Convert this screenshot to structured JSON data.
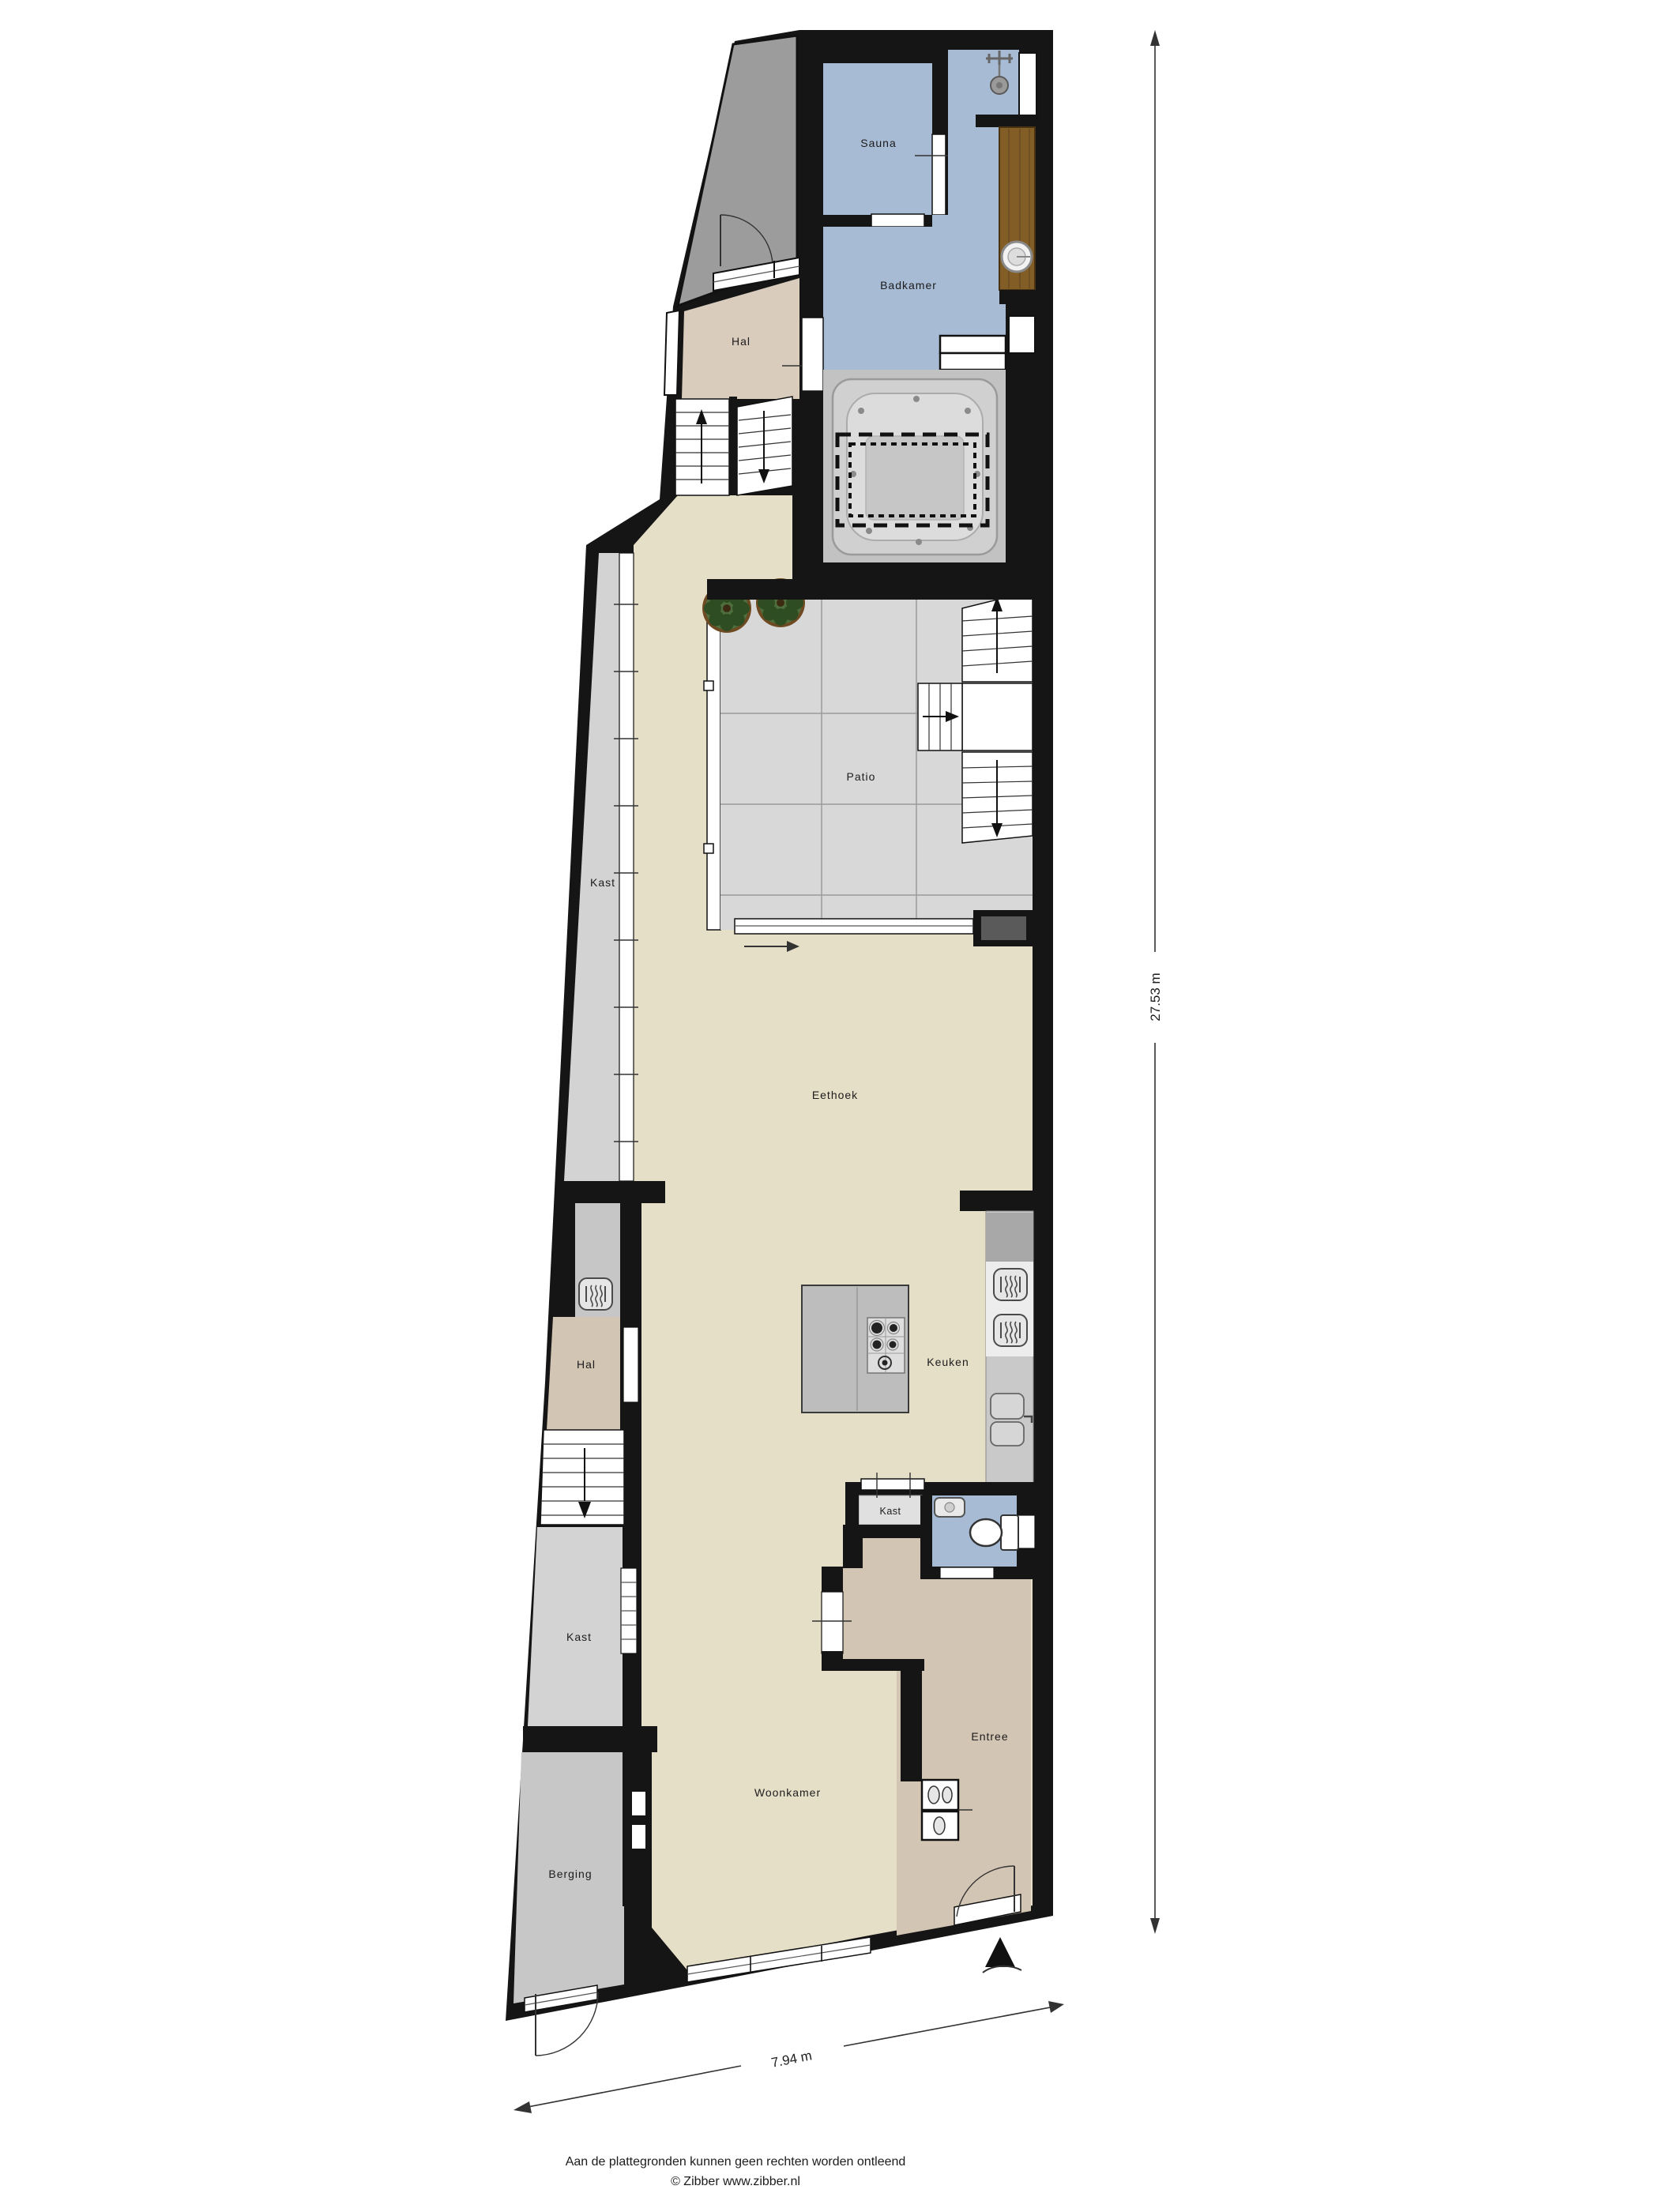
{
  "plan": {
    "title": "Begane grond plattegrond",
    "rooms": [
      {
        "id": "sauna",
        "label": "Sauna"
      },
      {
        "id": "badkamer",
        "label": "Badkamer"
      },
      {
        "id": "hal-boven",
        "label": "Hal"
      },
      {
        "id": "patio",
        "label": "Patio"
      },
      {
        "id": "kast-strook",
        "label": "Kast"
      },
      {
        "id": "eethoek",
        "label": "Eethoek"
      },
      {
        "id": "hal-beneden",
        "label": "Hal"
      },
      {
        "id": "keuken",
        "label": "Keuken"
      },
      {
        "id": "kast-onder",
        "label": "Kast"
      },
      {
        "id": "kast-klein",
        "label": "Kast"
      },
      {
        "id": "woonkamer",
        "label": "Woonkamer"
      },
      {
        "id": "entree",
        "label": "Entree"
      },
      {
        "id": "berging",
        "label": "Berging"
      }
    ],
    "fixtures": [
      "shower",
      "wash-basin",
      "jacuzzi",
      "staircase",
      "plant",
      "kitchen-island",
      "gas-hob",
      "oven",
      "kitchen-sink",
      "toilet",
      "corner-basin",
      "front-door",
      "north-arrow"
    ],
    "dimensions": {
      "height": "27.53 m",
      "width": "7.94 m"
    },
    "footer": {
      "line1": "Aan de plattegronden kunnen geen rechten worden ontleend",
      "line2": "© Zibber www.zibber.nl"
    },
    "palette": {
      "walls": "#151515",
      "cream": "#e6dfc8",
      "tan": "#d3c5b3",
      "tan_light": "#d9ccbc",
      "blue": "#a8bbd5",
      "patio": "#d8d8d8",
      "terrace_gray": "#9c9c9c",
      "kast_gray": "#d3d3d3",
      "berging_gray": "#c7c7c7",
      "niche_gray": "#c6c6c6",
      "wood": "#825d26",
      "counter": "#c9c9c9",
      "counter_dark": "#a8a8a8",
      "island": "#bdbdbd",
      "jacuzzi_bg": "#c2c2c2"
    }
  }
}
